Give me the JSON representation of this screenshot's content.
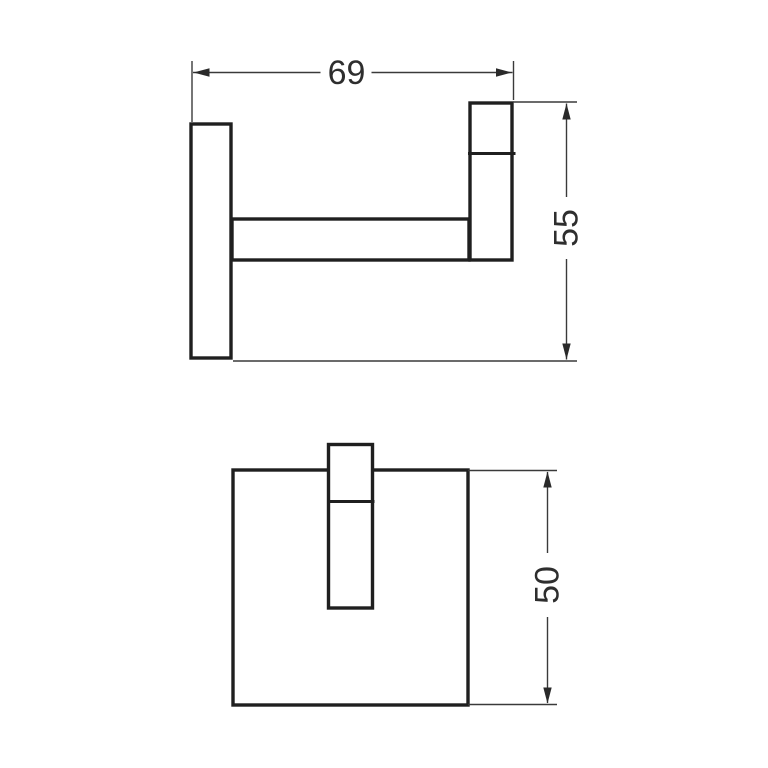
{
  "colors": {
    "background": "#ffffff",
    "outline": "#1f1f1f",
    "dimension_lines": "#3a3a3a",
    "arrow": "#2a2a2a",
    "text": "#2e2e2e"
  },
  "side_view": {
    "width_dim": "69",
    "height_dim": "55"
  },
  "front_view": {
    "height_dim": "50"
  }
}
